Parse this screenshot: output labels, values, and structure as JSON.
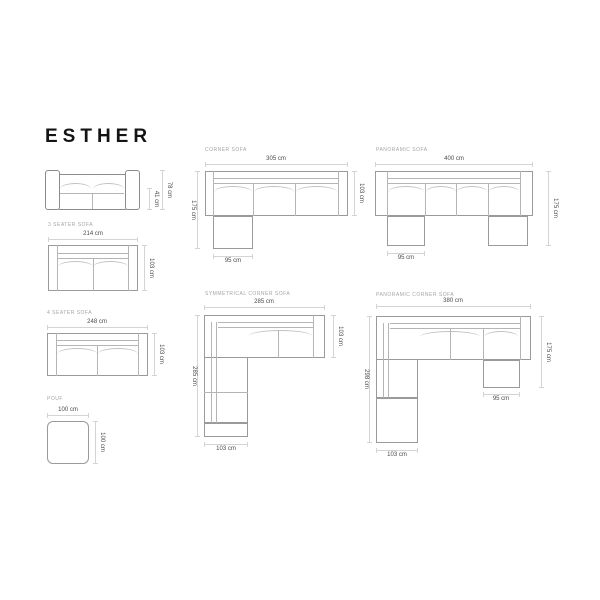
{
  "title": "ESTHER",
  "sections": {
    "front_view": {
      "height_total": "78 cm",
      "height_seat": "41 cm"
    },
    "three_seater": {
      "label": "3 SEATER SOFA",
      "width": "214 cm",
      "depth": "103 cm"
    },
    "four_seater": {
      "label": "4 SEATER SOFA",
      "width": "248 cm",
      "depth": "103 cm"
    },
    "pouf": {
      "label": "POUF",
      "width": "100 cm",
      "depth": "100 cm"
    },
    "corner": {
      "label": "CORNER SOFA",
      "width": "305 cm",
      "depth_total": "175 cm",
      "depth": "103 cm",
      "chaise_width": "95 cm"
    },
    "panoramic": {
      "label": "PANORAMIC SOFA",
      "width": "400 cm",
      "depth_total": "175 cm",
      "chaise_width": "95 cm"
    },
    "symmetrical_corner": {
      "label": "SYMMETRICAL CORNER SOFA",
      "width": "285 cm",
      "depth_total": "285 cm",
      "depth": "103 cm",
      "end_width": "103 cm"
    },
    "panoramic_corner": {
      "label": "PANORAMIC CORNER SOFA",
      "width": "380 cm",
      "depth_total": "298 cm",
      "right_depth": "175 cm",
      "chaise_width": "95 cm",
      "end_width": "103 cm"
    }
  },
  "colors": {
    "outline": "#9a9a9a",
    "outline_dark": "#8c8c8c",
    "inner_line": "#b5b5b5",
    "dim_line": "#d4d4d4",
    "dim_text": "#4a4a4a",
    "section_label": "#a5a5a5",
    "title_text": "#141414",
    "background": "#ffffff"
  }
}
